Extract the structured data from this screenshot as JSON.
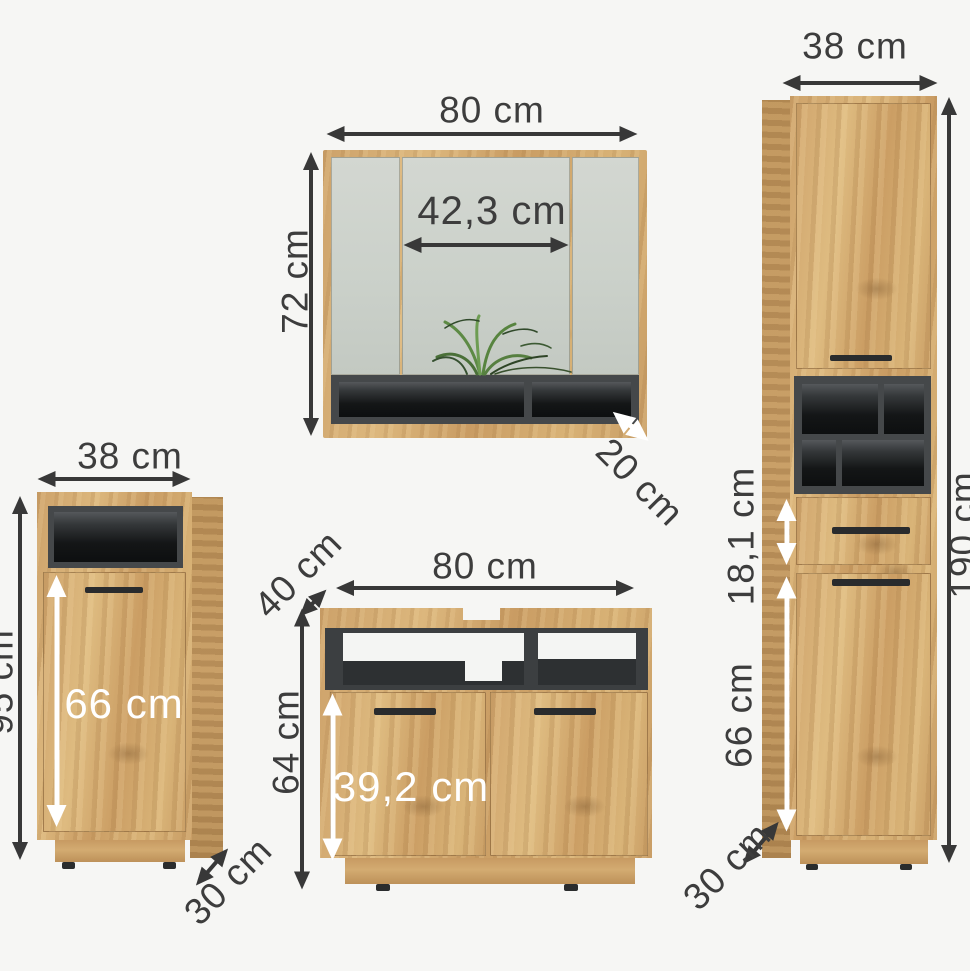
{
  "units": "cm",
  "colors": {
    "wood": "#cda26a",
    "wood_dark": "#bd9259",
    "mirror": "#ccd1ca",
    "cavity_frame": "#45484a",
    "cavity_interior": "#141617",
    "background": "#f6f6f4",
    "dimension_text": "#3d3d3d",
    "white_text": "#ffffff",
    "plant_green": "#57843f"
  },
  "mirror_cabinet": {
    "width": "80 cm",
    "height": "72 cm",
    "inner_width": "42,3 cm",
    "depth": "20 cm"
  },
  "side_cabinet": {
    "width": "38 cm",
    "height": "95 cm",
    "door_height": "66 cm",
    "depth": "30 cm"
  },
  "vanity_cabinet": {
    "width": "80 cm",
    "depth": "40 cm",
    "height": "64 cm",
    "door_height": "39,2 cm"
  },
  "tall_cabinet": {
    "width": "38 cm",
    "height": "190 cm",
    "drawer_height": "18,1 cm",
    "door_height": "66 cm",
    "depth": "30 cm"
  }
}
